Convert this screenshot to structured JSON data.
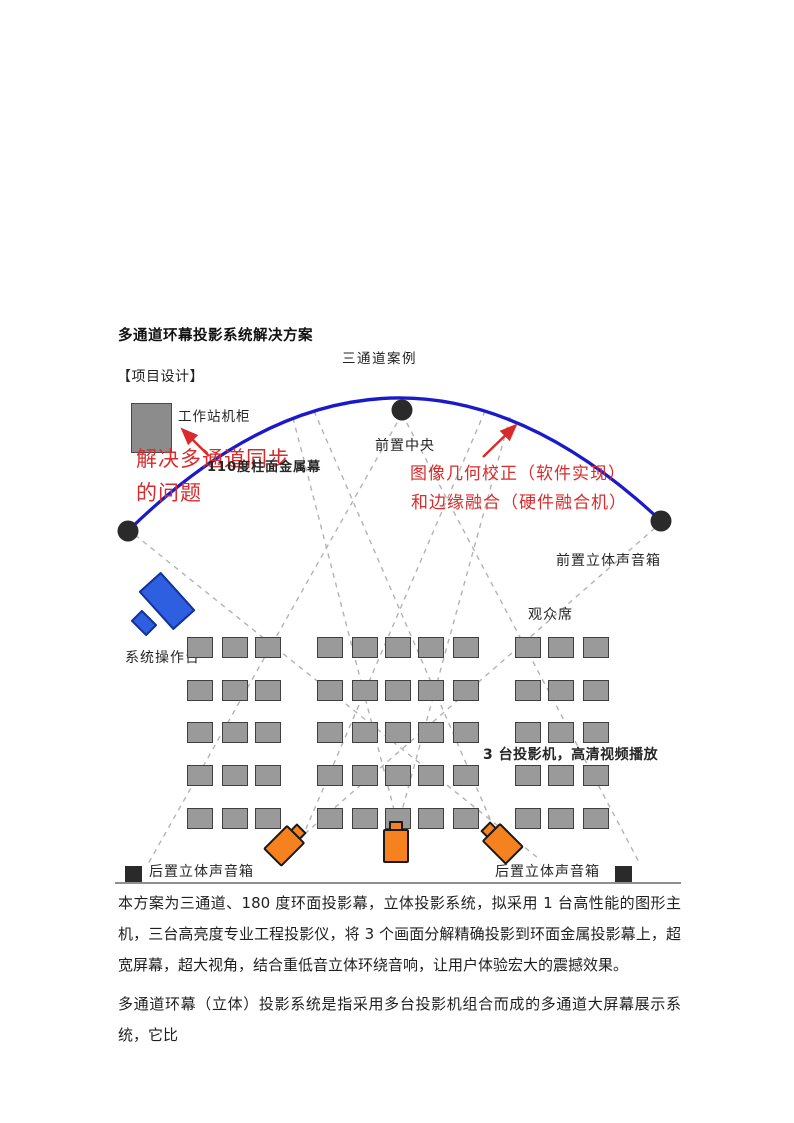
{
  "page": {
    "title": "多通道环幕投影系统解决方案",
    "subtitle": "三通道案例",
    "section_heading": "【项目设计】"
  },
  "diagram": {
    "workstation_label": "工作站机柜",
    "sync_note": {
      "line1": "解决多通道同步",
      "line2": "的问题"
    },
    "screen_label": "110度柱面金属幕",
    "front_center_label": "前置中央",
    "correction_note": {
      "line1": "图像几何校正（软件实现）",
      "line2": "和边缘融合（硬件融合机）"
    },
    "front_speaker_label": "前置立体声音箱",
    "audience_label": "观众席",
    "console_label": "系统操作台",
    "projectors_note": "3 台投影机，高清视频播放",
    "rear_speaker_left_label": "后置立体声音箱",
    "rear_speaker_right_label": "后置立体声音箱",
    "projector_count": 3
  },
  "seating": {
    "rows_y": [
      637,
      680,
      722,
      765,
      808
    ],
    "cols_x": [
      187,
      222,
      255,
      317,
      352,
      385,
      418,
      453,
      515,
      548,
      583
    ],
    "seat_width": 26,
    "seat_height": 21,
    "rows": 5,
    "seats_per_row": 11
  },
  "body": {
    "paragraph1": "本方案为三通道、180 度环面投影幕，立体投影系统，拟采用 1 台高性能的图形主机，三台高亮度专业工程投影仪，将 3 个画面分解精确投影到环面金属投影幕上，超宽屏幕，超大视角，结合重低音立体环绕音响，让用户体验宏大的震撼效果。",
    "paragraph2": "多通道环幕（立体）投影系统是指采用多台投影机组合而成的多通道大屏幕展示系统，它比"
  },
  "colors": {
    "screen_arc_blue": "#1a1acc",
    "annotation_red": "#d92b2b",
    "projector_orange": "#f5821f",
    "console_blue": "#2d5fe0",
    "seat_gray": "#9a9a9a",
    "marker_black": "#2a2a2a"
  }
}
